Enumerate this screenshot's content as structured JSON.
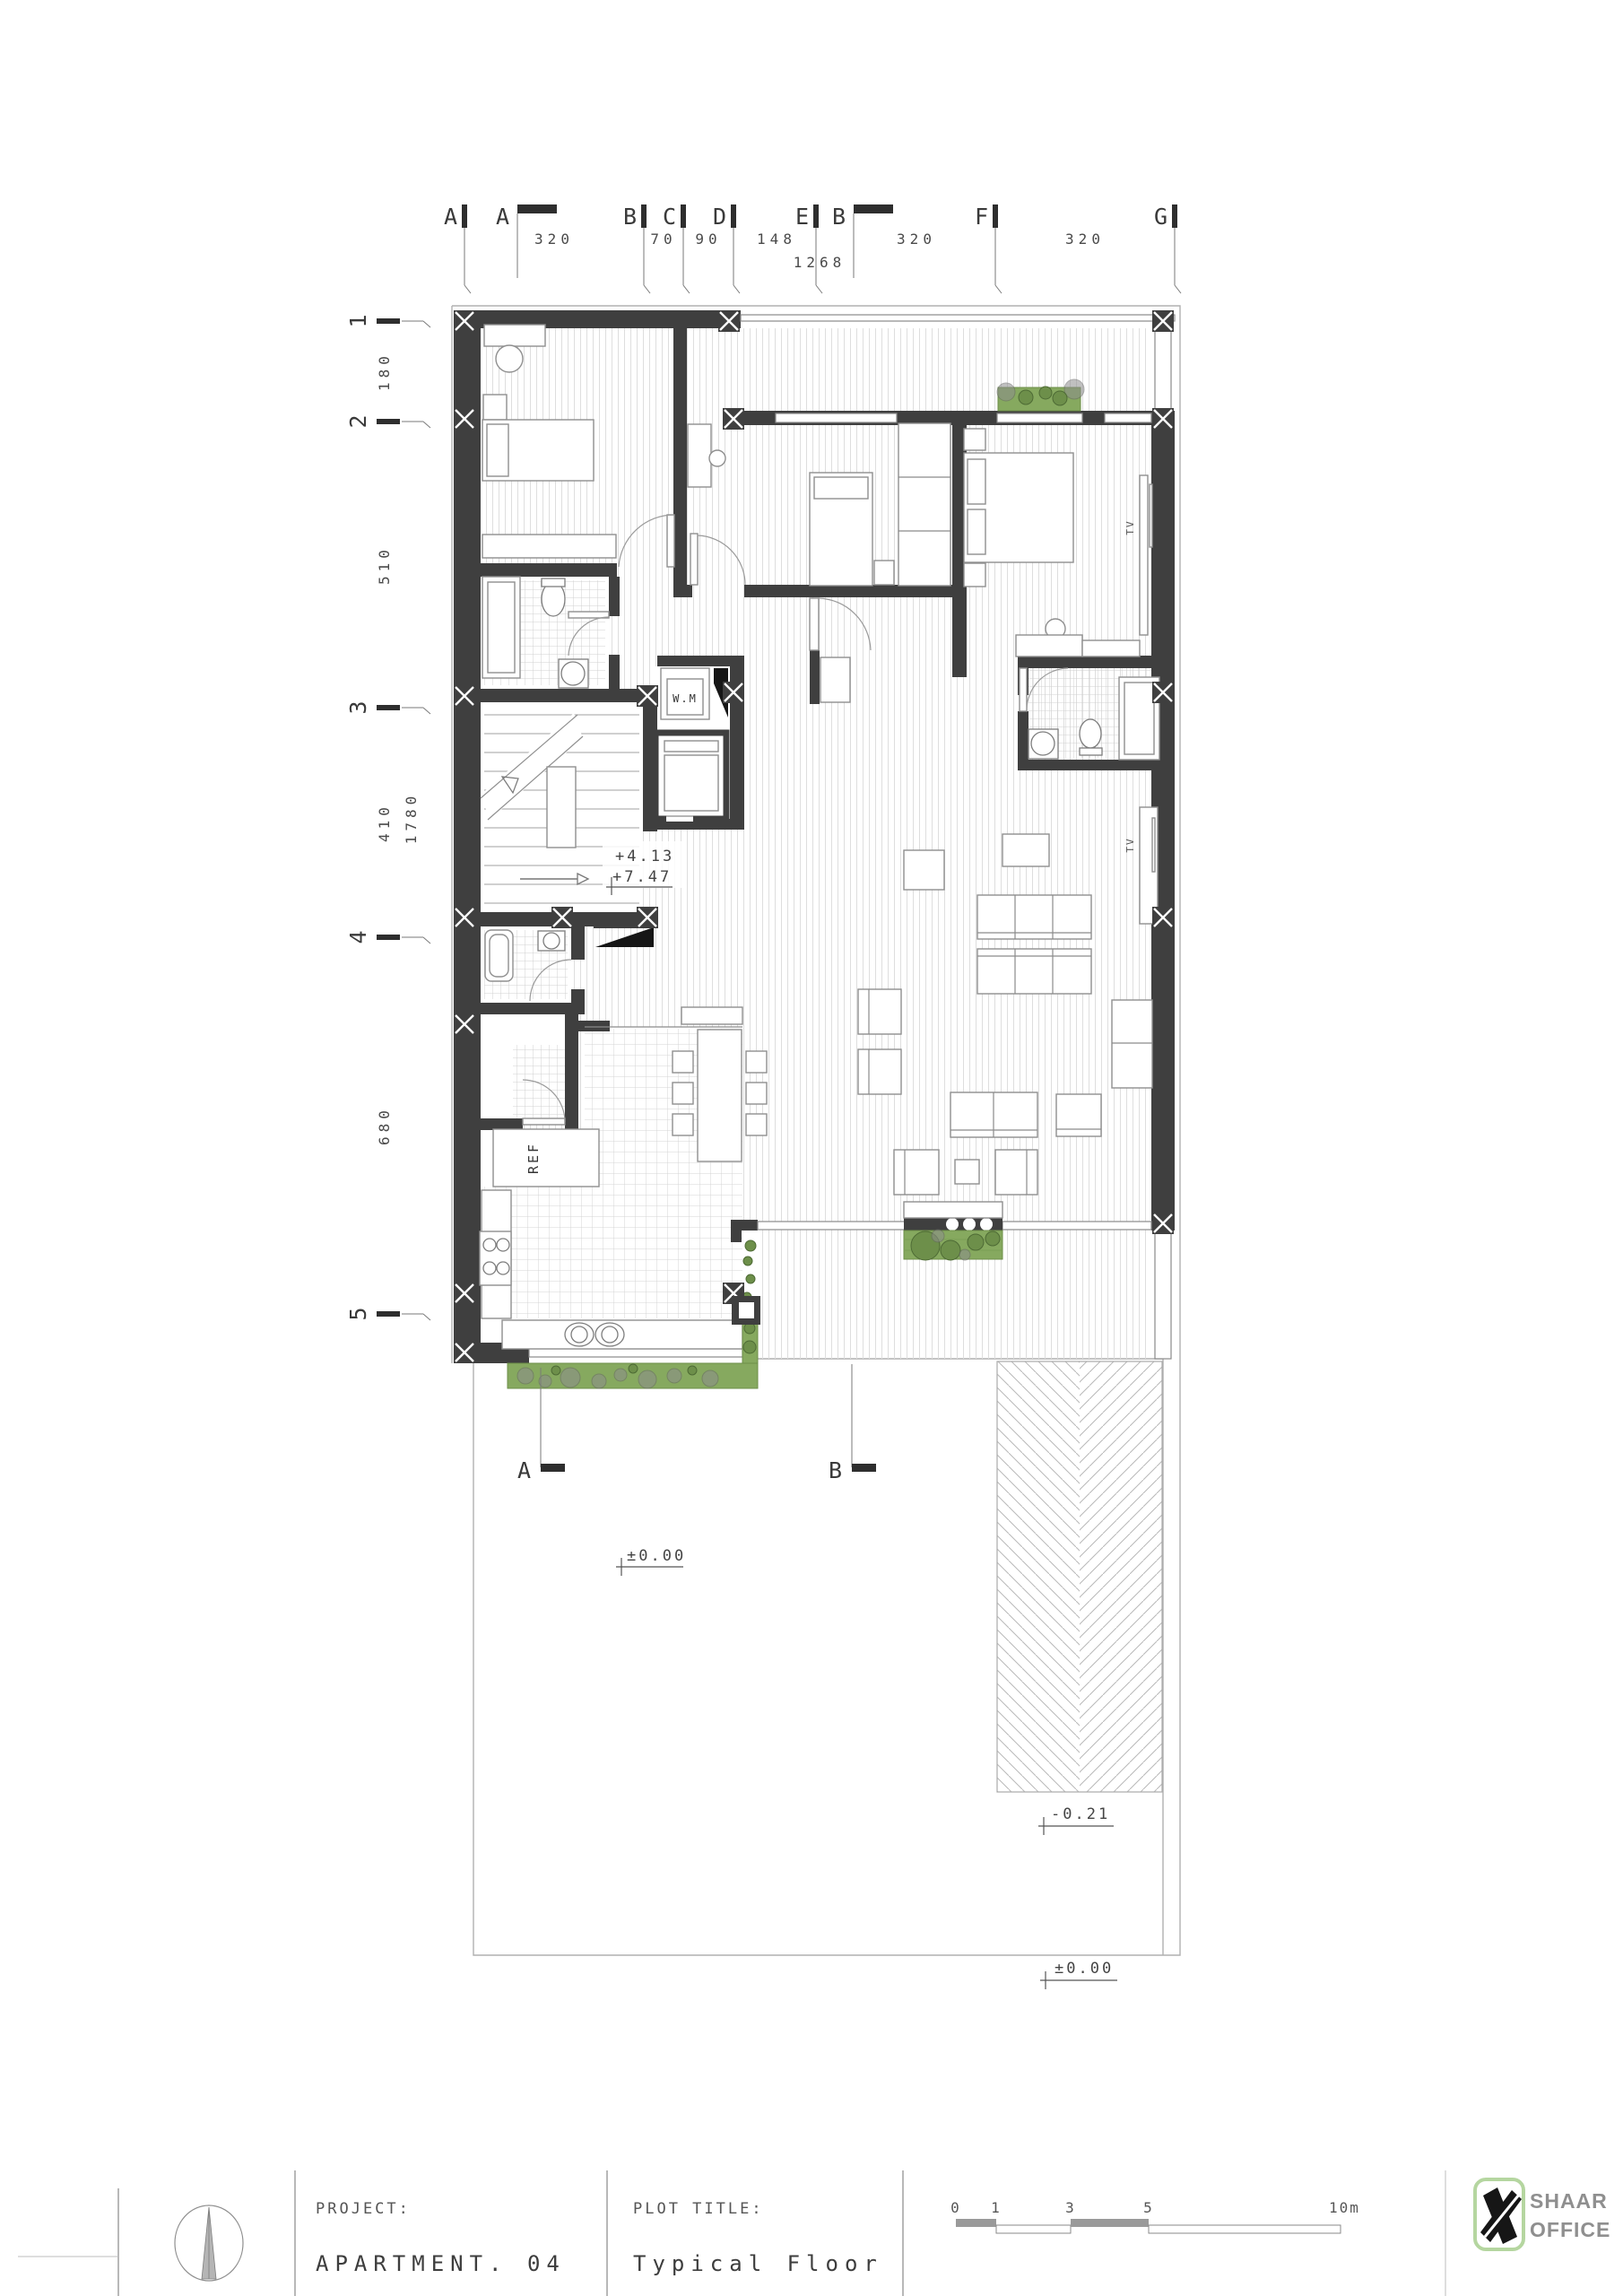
{
  "plan": {
    "grid_cols": [
      "A",
      "B",
      "C",
      "D",
      "E",
      "F",
      "G"
    ],
    "grid_rows": [
      "1",
      "2",
      "3",
      "4",
      "5"
    ],
    "dims_top": [
      "320",
      "70",
      "90",
      "148",
      "320",
      "320"
    ],
    "dim_top_total": "1268",
    "dims_left": [
      "180",
      "510",
      "410",
      "680"
    ],
    "dim_left_total": "1780",
    "sections": {
      "top_a": "A",
      "top_b": "B",
      "bot_a": "A",
      "bot_b": "B"
    },
    "levels": {
      "stair_a": "+4.13",
      "stair_b": "+7.47",
      "yard": "±0.00",
      "ramp": "-0.21",
      "street": "±0.00"
    },
    "labels": {
      "wm": "W.M",
      "ref": "REF",
      "tv_bedroom": "TV",
      "tv_living": "TV"
    }
  },
  "titleblock": {
    "project_label": "PROJECT:",
    "project_value": "APARTMENT. 04",
    "plot_label": "PLOT TITLE:",
    "plot_value": "Typical Floor",
    "scalebar": {
      "t0": "0",
      "t1": "1",
      "t3": "3",
      "t5": "5",
      "t10": "10m"
    },
    "logo": {
      "line1": "SHAAR",
      "line2": "OFFICE"
    }
  }
}
